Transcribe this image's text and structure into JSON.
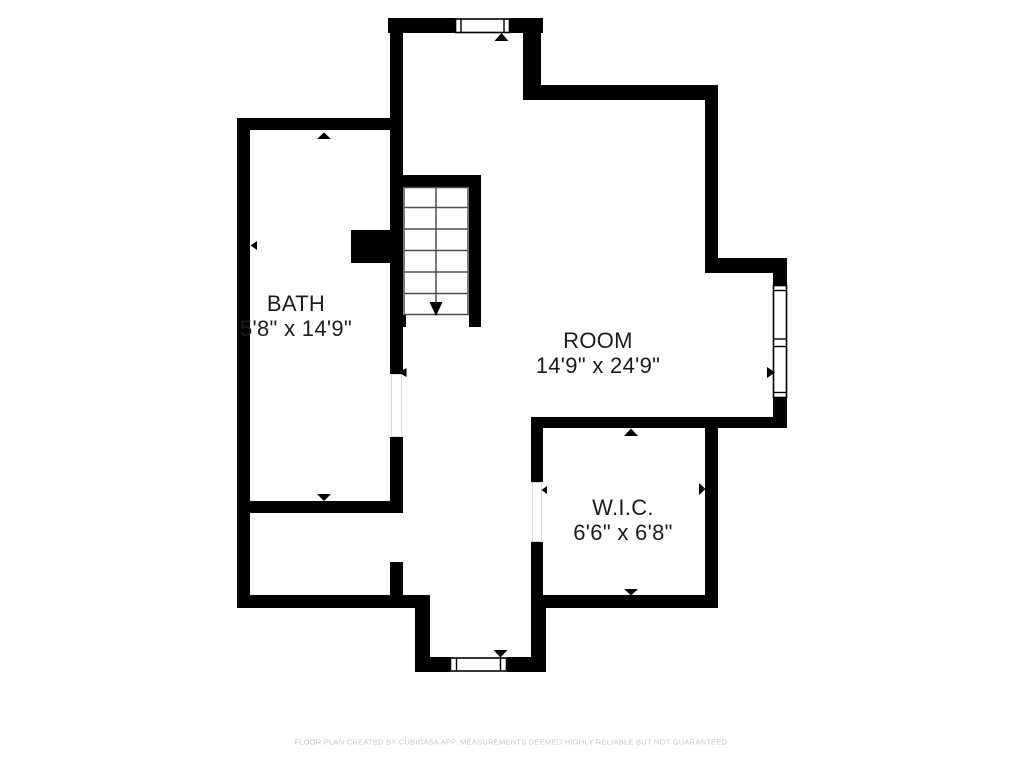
{
  "rooms": [
    {
      "name": "BATH",
      "dimensions": "5'8\" x 14'9\""
    },
    {
      "name": "ROOM",
      "dimensions": "14'9\" x 24'9\""
    },
    {
      "name": "W.I.C.",
      "dimensions": "6'6\" x 6'8\""
    }
  ],
  "stairs": {
    "treads": 6,
    "direction": "down"
  },
  "footer": {
    "text": "FLOOR PLAN CREATED BY CUBICASA APP. MEASUREMENTS DEEMED HIGHLY RELIABLE BUT NOT GUARANTEED."
  },
  "colors": {
    "wall": "#000000",
    "background": "#ffffff",
    "footer_text": "#c9c9c9",
    "stair_lines": "#4d4d4d",
    "door_jamb": "#dcdcdc",
    "label_text": "#1c1c1c"
  }
}
